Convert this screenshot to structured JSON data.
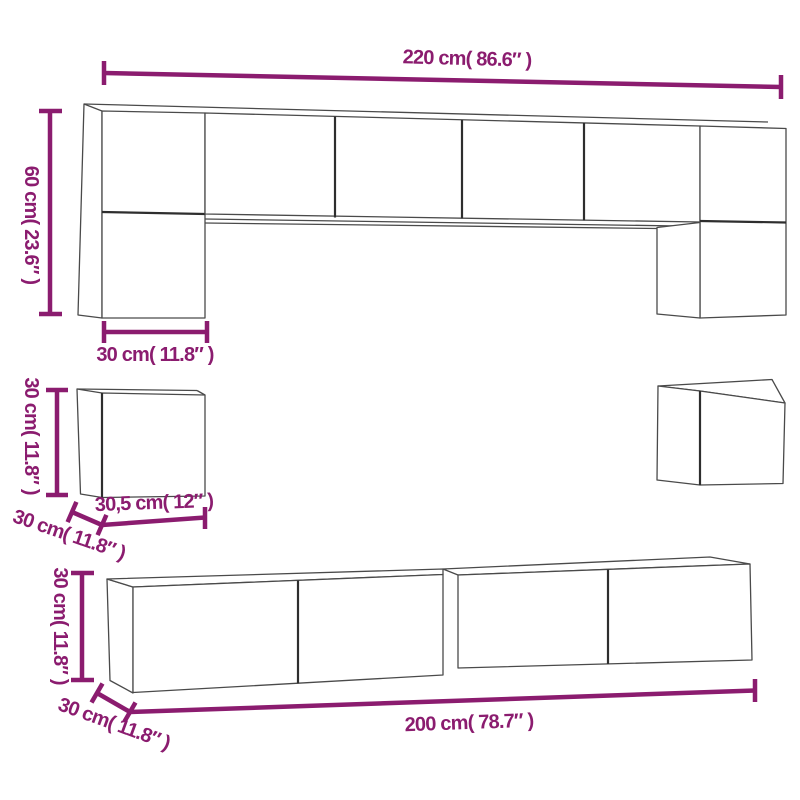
{
  "diagram": {
    "title": "furniture-set-dimension-diagram",
    "pieces": [
      "wall-unit-bridge",
      "wall-cube-left",
      "wall-cube-right",
      "tv-stand-left",
      "tv-stand-right"
    ]
  },
  "colors": {
    "dimension": "#8b1c6f",
    "outline": "#4a4a4a",
    "outline_dark": "#2e2e2e",
    "background": "#ffffff"
  },
  "labels": {
    "wall_width": "220 cm( 86.6″ )",
    "wall_height": "60 cm( 23.6″ )",
    "wall_cabinet_width": "30 cm( 11.8″ )",
    "cube_height": "30 cm( 11.8″ )",
    "cube_width": "30,5 cm( 12″ )",
    "cube_depth": "30 cm( 11.8″ )",
    "stand_height": "30 cm( 11.8″ )",
    "stand_depth": "30 cm( 11.8″ )",
    "stand_width": "200 cm( 78.7″ )"
  }
}
